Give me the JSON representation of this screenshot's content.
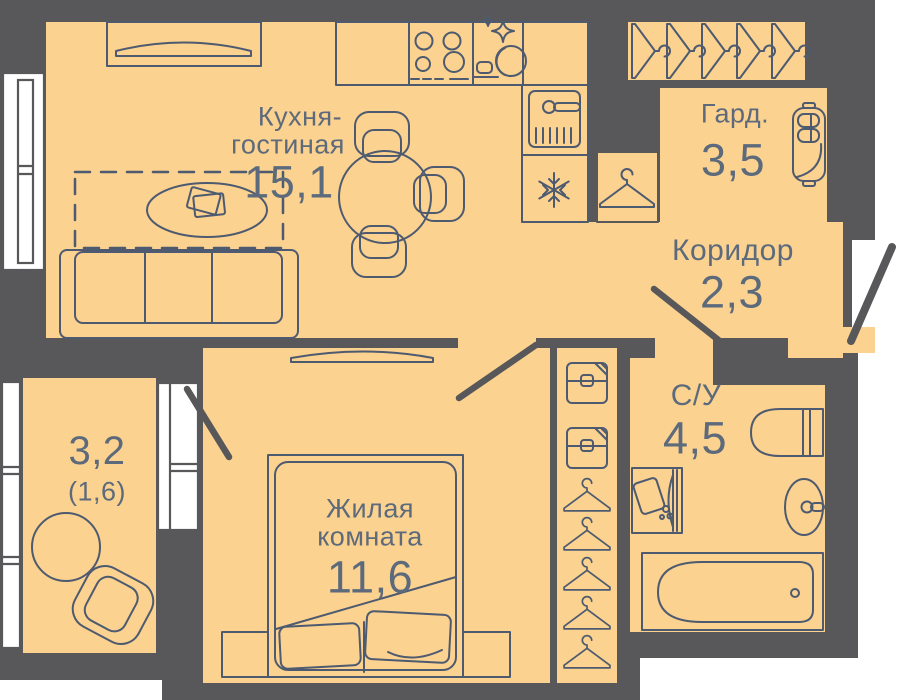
{
  "plan": {
    "type": "apartment-floorplan",
    "colors": {
      "wall": "#58585A",
      "floor": "#FBD28F",
      "line": "#4D5A70",
      "text": "#5C6A7C",
      "window": "#FFFFFF"
    },
    "rooms": {
      "kitchen_living": {
        "label_line1": "Кухня-",
        "label_line2": "гостиная",
        "area": "15,1"
      },
      "wardrobe": {
        "label": "Гард.",
        "area": "3,5"
      },
      "corridor": {
        "label": "Коридор",
        "area": "2,3"
      },
      "bathroom": {
        "label": "С/У",
        "area": "4,5"
      },
      "bedroom": {
        "label_line1": "Жилая",
        "label_line2": "комната",
        "area": "11,6"
      },
      "balcony": {
        "area": "3,2",
        "area_secondary": "(1,6)"
      }
    },
    "icons": [
      "hanger-icon",
      "snowflake-icon",
      "sparkle-dish-icon",
      "stove-burners-icon",
      "sink-faucet-icon",
      "storage-box-icon"
    ]
  }
}
